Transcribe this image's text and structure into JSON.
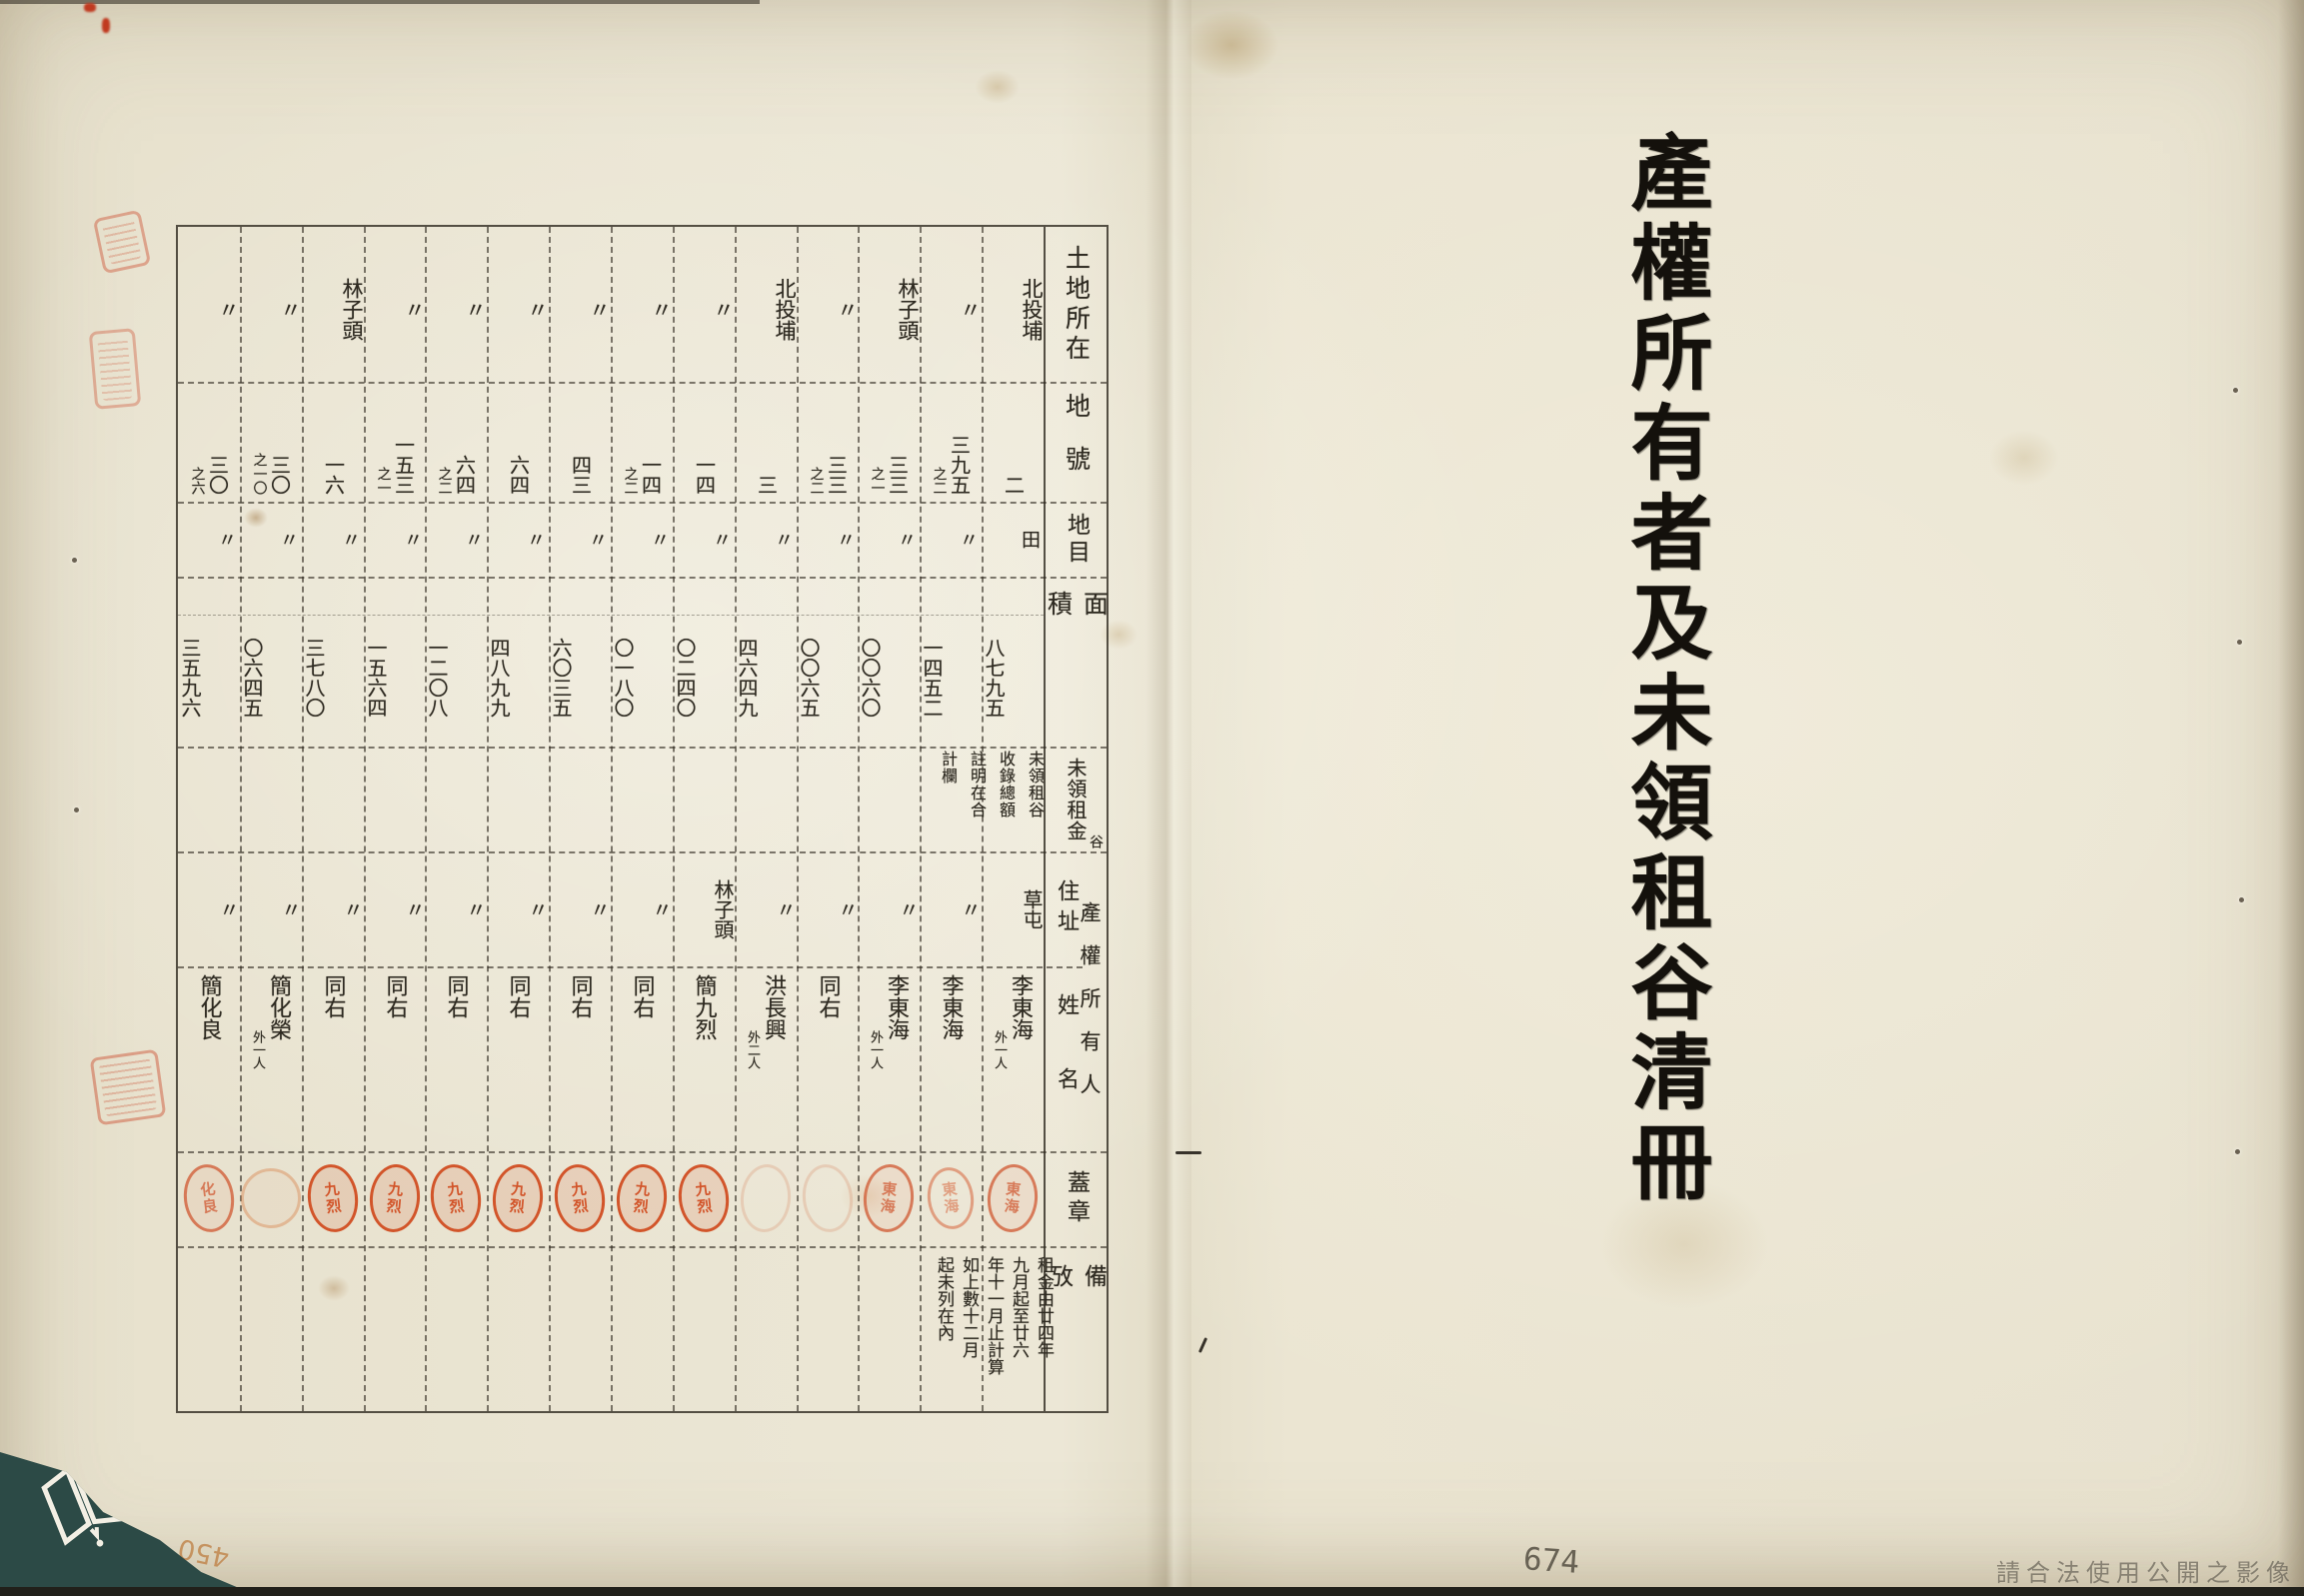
{
  "page": {
    "title_vertical": "產權所有者及未領租谷清冊",
    "page_number": "674",
    "corner_handwritten_number": "450",
    "watermark": "請合法使用公開之影像",
    "ditto_mark": "〃"
  },
  "colors": {
    "paper": "#e9e3d0",
    "ink": "#2e2a21",
    "seal_red": "#d14e22",
    "logo_teal": "#2c4a46",
    "table_line": "#45403a"
  },
  "icons": {
    "corner_logo": "archive-book-logo",
    "margin_seals": "red-seal-imprint"
  },
  "table": {
    "headers": {
      "location": "土地所在",
      "lot_number": "地號",
      "land_category": "地目",
      "area": "面積",
      "unclaimed_rent": "未領租金",
      "unclaimed_rent_correction": "谷",
      "owner_group": "產權所有人",
      "address": "住址",
      "name": "姓名",
      "seal": "蓋章",
      "remarks": "備攷"
    },
    "rent_note_lines": [
      "未領租谷",
      "收錄總額",
      "註明在合",
      "計欄"
    ],
    "remarks_note_lines": [
      "租金由廿四年",
      "九月起至廿六",
      "年十一月止計算",
      "如上數十二月",
      "起未列在內"
    ],
    "columns": [
      {
        "location": "北投埔",
        "lot": "二",
        "lot_sub": "",
        "category": "田",
        "area": "八七九五",
        "address": "草屯",
        "name": "李東海",
        "name_annotation": "外一人",
        "seal_text": "東海",
        "seal_style": "medium"
      },
      {
        "location": "〃",
        "lot": "三九五",
        "lot_sub": "之二",
        "category": "〃",
        "area": "一四五二",
        "address": "〃",
        "name": "李東海",
        "name_annotation": "",
        "seal_text": "東海",
        "seal_style": "light"
      },
      {
        "location": "林子頭",
        "lot": "三三",
        "lot_sub": "之一",
        "category": "〃",
        "area": "〇〇六〇",
        "address": "〃",
        "name": "李東海",
        "name_annotation": "外一人",
        "seal_text": "東海",
        "seal_style": "medium"
      },
      {
        "location": "〃",
        "lot": "三三",
        "lot_sub": "之二",
        "category": "〃",
        "area": "〇〇六五",
        "address": "〃",
        "name": "同右",
        "name_annotation": "",
        "seal_text": "",
        "seal_style": "faint"
      },
      {
        "location": "北投埔",
        "lot": "三",
        "lot_sub": "",
        "category": "〃",
        "area": "四六四九",
        "address": "〃",
        "name": "洪長興",
        "name_annotation": "外二人",
        "seal_text": "",
        "seal_style": "faint"
      },
      {
        "location": "〃",
        "lot": "一四",
        "lot_sub": "",
        "category": "〃",
        "area": "〇二四〇",
        "address": "林子頭",
        "name": "簡九烈",
        "name_annotation": "",
        "seal_text": "九烈",
        "seal_style": "strong"
      },
      {
        "location": "〃",
        "lot": "一四",
        "lot_sub": "之二",
        "category": "〃",
        "area": "〇一八〇",
        "address": "〃",
        "name": "同右",
        "name_annotation": "",
        "seal_text": "九烈",
        "seal_style": "strong"
      },
      {
        "location": "〃",
        "lot": "四三",
        "lot_sub": "",
        "category": "〃",
        "area": "六〇三五",
        "address": "〃",
        "name": "同右",
        "name_annotation": "",
        "seal_text": "九烈",
        "seal_style": "strong"
      },
      {
        "location": "〃",
        "lot": "六四",
        "lot_sub": "",
        "category": "〃",
        "area": "四八九九",
        "address": "〃",
        "name": "同右",
        "name_annotation": "",
        "seal_text": "九烈",
        "seal_style": "strong"
      },
      {
        "location": "〃",
        "lot": "六四",
        "lot_sub": "之二",
        "category": "〃",
        "area": "一二〇八",
        "address": "〃",
        "name": "同右",
        "name_annotation": "",
        "seal_text": "九烈",
        "seal_style": "strong"
      },
      {
        "location": "〃",
        "lot": "一五三",
        "lot_sub": "之一",
        "category": "〃",
        "area": "一五六四",
        "address": "〃",
        "name": "同右",
        "name_annotation": "",
        "seal_text": "九烈",
        "seal_style": "strong"
      },
      {
        "location": "林子頭",
        "lot": "一六",
        "lot_sub": "",
        "category": "〃",
        "area": "三七八〇",
        "address": "〃",
        "name": "同右",
        "name_annotation": "",
        "seal_text": "九烈",
        "seal_style": "strong"
      },
      {
        "location": "〃",
        "lot": "三〇",
        "lot_sub": "之一〇",
        "category": "〃",
        "area": "〇六四五",
        "address": "〃",
        "name": "簡化榮",
        "name_annotation": "外一人",
        "seal_text": "",
        "seal_style": "round"
      },
      {
        "location": "〃",
        "lot": "三〇",
        "lot_sub": "之六",
        "category": "〃",
        "area": "三五九六",
        "address": "〃",
        "name": "簡化良",
        "name_annotation": "",
        "seal_text": "化良",
        "seal_style": "medium"
      }
    ]
  }
}
